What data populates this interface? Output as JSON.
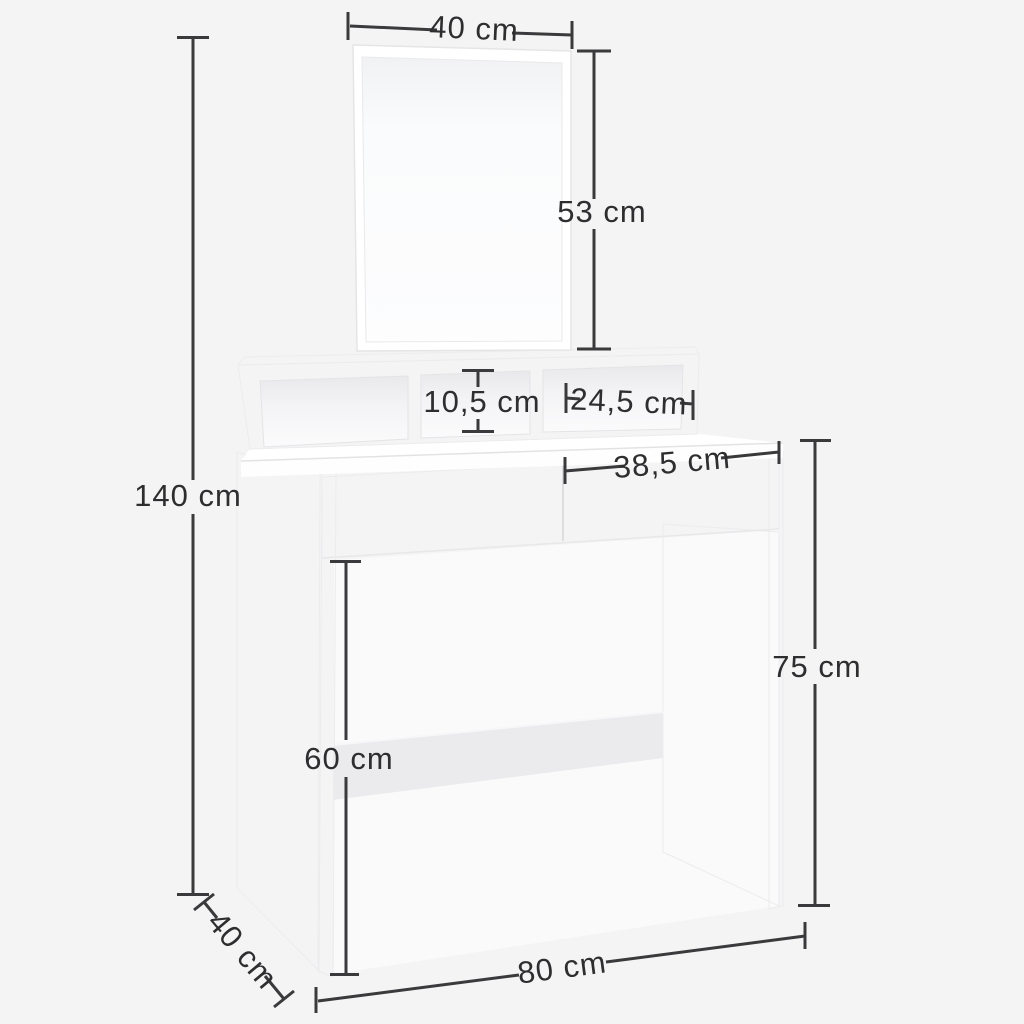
{
  "image": {
    "type": "product-dimension-diagram",
    "subject": "White dressing table with mirror, three open compartments, two drawers and a crossbar",
    "background_color": "#f4f4f5",
    "line_color": "#3a3a3c",
    "text_color": "#2e2e30",
    "furniture_color": "#ffffff",
    "shade_color": "#ededef"
  },
  "dimensions": {
    "mirror_width": "40 cm",
    "mirror_height": "53 cm",
    "overall_height": "140 cm",
    "compartment_height": "10,5 cm",
    "compartment_width": "24,5 cm",
    "drawer_width": "38,5 cm",
    "tabletop_height": "75 cm",
    "leg_clearance_height": "60 cm",
    "depth": "40 cm",
    "width": "80 cm"
  }
}
